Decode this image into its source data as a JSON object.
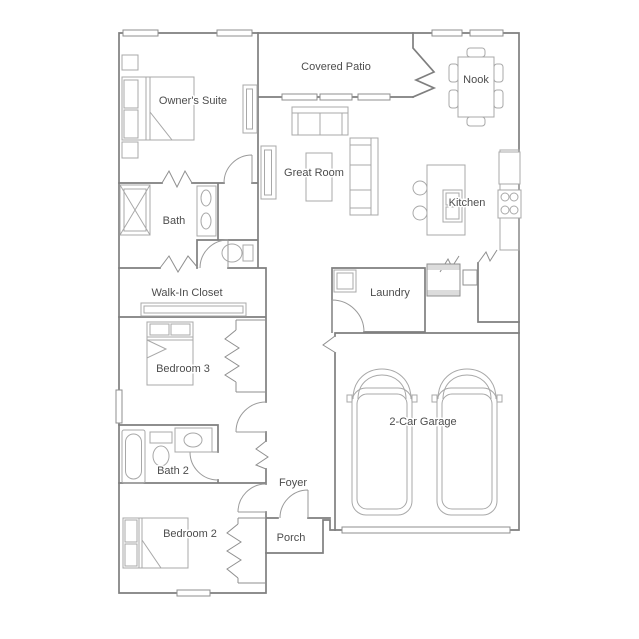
{
  "plan": {
    "labels": {
      "owners_suite": "Owner's Suite",
      "covered_patio": "Covered Patio",
      "nook": "Nook",
      "great_room": "Great Room",
      "kitchen": "Kitchen",
      "bath": "Bath",
      "walk_in_closet": "Walk-In Closet",
      "bedroom3": "Bedroom 3",
      "laundry": "Laundry",
      "garage": "2-Car Garage",
      "bath2": "Bath 2",
      "foyer": "Foyer",
      "bedroom2": "Bedroom 2",
      "porch": "Porch"
    },
    "colors": {
      "background": "#ffffff",
      "walls": "#7f7f7f",
      "furniture": "#a8a8a8",
      "fixtures": "#8f8f8f",
      "label_text": "#4d4d4d",
      "threshold_fill": "#dcdcdc"
    },
    "icons": [
      "bed-icon",
      "nightstand-icon",
      "dresser-icon",
      "sofa-icon",
      "sectional-sofa-icon",
      "coffee-table-icon",
      "tv-console-icon",
      "dining-table-icon",
      "dining-chair-icon",
      "kitchen-island-icon",
      "sink-icon",
      "bar-stool-icon",
      "refrigerator-icon",
      "range-stove-icon",
      "shower-icon",
      "double-vanity-icon",
      "toilet-icon",
      "bathtub-icon",
      "wardrobe-shelf-icon",
      "washer-dryer-icon",
      "car-icon",
      "door-swing-icon",
      "window-icon",
      "sliding-door-icon",
      "garage-door-icon",
      "wall-opening-icon"
    ]
  }
}
